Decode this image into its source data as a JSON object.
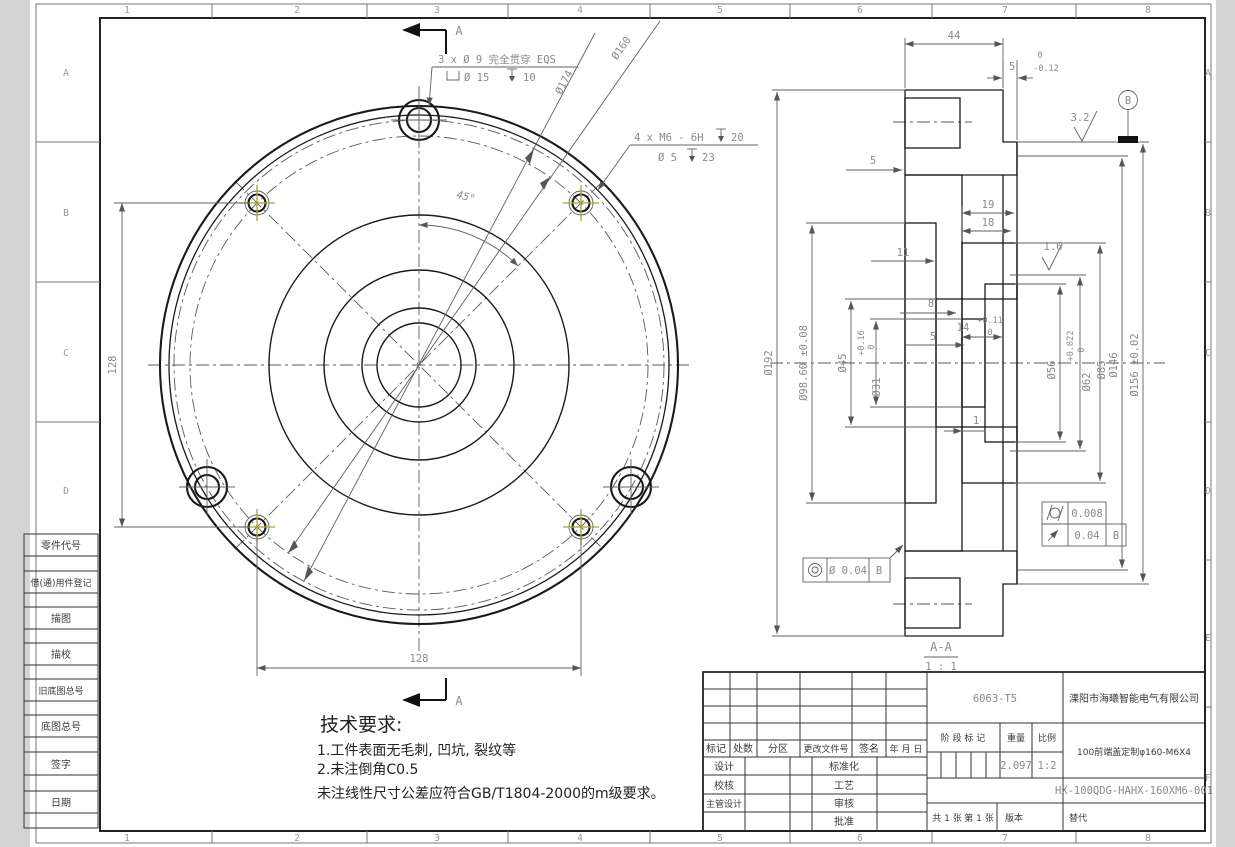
{
  "zones": {
    "top": [
      "1",
      "2",
      "3",
      "4",
      "5",
      "6",
      "7",
      "8"
    ],
    "left": [
      "A",
      "B",
      "C",
      "D"
    ],
    "right": [
      "A",
      "B",
      "C",
      "D",
      "E",
      "F"
    ]
  },
  "front_view": {
    "note_holes3": "3 x Ø 9 完全贯穿 EQS",
    "note_holes3_cbore_dia": "Ø 15",
    "note_holes3_cbore_depth": "10",
    "note_holes4": "4 x M6 - 6H",
    "note_holes4_depth": "20",
    "note_holes4_pilot_dia": "Ø 5",
    "note_holes4_pilot_depth": "23",
    "dia_174": "Ø174",
    "dia_160": "Ø160",
    "angle": "45°",
    "dim_height": "128",
    "dim_width": "128",
    "section_letter": "A"
  },
  "section_view": {
    "label": "A-A",
    "scale": "1 : 1",
    "dims": {
      "d44": "44",
      "lip": "5",
      "lip_tol_up": "0",
      "lip_tol_dn": "-0.12",
      "d5a": "5",
      "d19": "19",
      "d18": "18",
      "d11": "11",
      "d8": "8",
      "d14": "14",
      "d14_tol_up": "+0.11",
      "d14_tol_dn": "0",
      "d5b": "5",
      "d1": "1"
    },
    "dias": {
      "d192": "Ø192",
      "d986": "Ø98.60 ±0.08",
      "d45": "Ø45",
      "d31": "Ø31",
      "d31_tol_up": "+0.16",
      "d31_tol_dn": "0",
      "d56": "Ø56",
      "d62": "Ø62",
      "d62_tol_up": "+0.022",
      "d62_tol_dn": "0",
      "d85": "Ø85",
      "d146": "Ø146",
      "d156": "Ø156 ±0.02"
    },
    "finish": {
      "f16": "1.6",
      "f32": "3.2"
    },
    "datum": "B",
    "fcf": {
      "cyl_val": "0.008",
      "runout_val": "0.04",
      "runout_datum": "B",
      "conc_val": "Ø 0.04",
      "conc_datum": "B"
    }
  },
  "tech_req": {
    "title": "技术要求:",
    "line1": "1.工件表面无毛刺, 凹坑, 裂纹等",
    "line2": "2.未注倒角C0.5",
    "line3": "未注线性尺寸公差应符合GB/T1804-2000的m级要求。"
  },
  "left_column": {
    "labels": [
      "零件代号",
      "借(通)用件登记",
      "描图",
      "描校",
      "旧底图总号",
      "底图总号",
      "签字",
      "日期"
    ]
  },
  "title_block": {
    "material": "6063-T5",
    "company": "溧阳市海曦智能电气有限公司",
    "rev_headers": [
      "标记",
      "处数",
      "分区",
      "更改文件号",
      "签名",
      "年 月 日"
    ],
    "roles_left": [
      "设计",
      "校核",
      "主管设计"
    ],
    "roles_right": [
      "标准化",
      "工艺",
      "审核",
      "批准"
    ],
    "stage_label": "阶 段 标 记",
    "weight_label": "重量",
    "scale_label": "比例",
    "weight": "2.097",
    "scale": "1:2",
    "part_name": "100前端盖定制φ160-M6X4",
    "drawing_no": "HX-100QDG-HAHX-160XM6-001",
    "sheets": "共 1 张",
    "sheet_no": "第 1 张",
    "version_label": "版本",
    "substitute_label": "替代"
  },
  "colors": {
    "marker_olive": "#a8a435",
    "line_dark": "#1a1a1a",
    "dim_gray": "#8a8a8a"
  }
}
